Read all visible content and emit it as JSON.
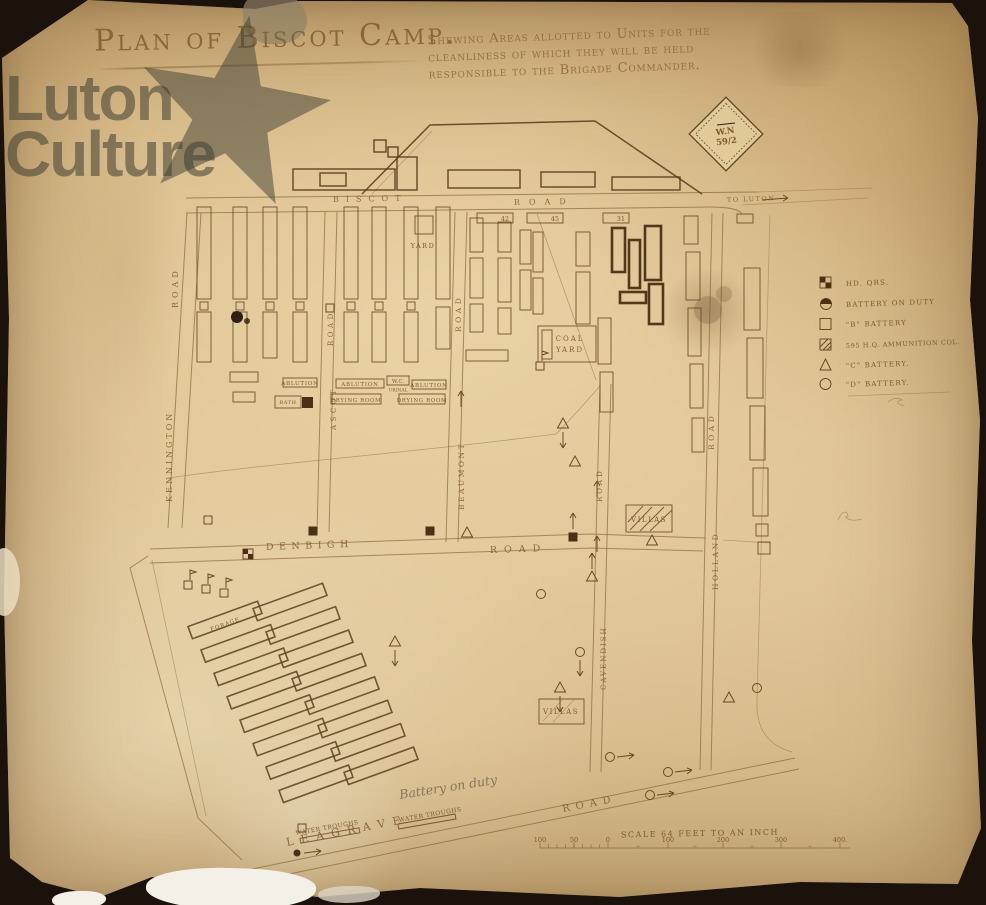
{
  "title": {
    "main": "Plan of Biscot Camp.",
    "sub1": "Shewing Areas allotted to Units for the",
    "sub2": "cleanliness of which they will be held",
    "sub3": "responsible to the Brigade Commander."
  },
  "watermark": {
    "line1": "Luton",
    "line2": "Culture"
  },
  "stamp": {
    "line1": "W.N",
    "line2": "59/2"
  },
  "roads": {
    "biscot": {
      "name": "BISCOT",
      "suffix": "ROAD"
    },
    "to_luton": "TO LUTON",
    "kennington": {
      "name": "KENNINGTON",
      "suffix": "ROAD"
    },
    "ascot": {
      "name": "ASCOT",
      "suffix": "ROAD"
    },
    "beaumont": {
      "name": "BEAUMONT",
      "suffix": "ROAD"
    },
    "cavendish": {
      "name": "CAVENDISH",
      "suffix": "ROAD"
    },
    "holland": {
      "name": "HOLLAND",
      "suffix": "ROAD"
    },
    "denbigh": {
      "name": "DENBIGH",
      "suffix": "ROAD"
    },
    "leagrave": {
      "name": "LEAGRAVE",
      "suffix": "ROAD"
    }
  },
  "labels": {
    "yard": "YARD",
    "coal_yard_line1": "COAL",
    "coal_yard_line2": "YARD",
    "villas_upper": "VILLAS",
    "villas_lower": "VILLAS",
    "ablution_1": "ABLUTION",
    "ablution_2": "ABLUTION",
    "ablution_3": "ABLUTION",
    "drying_room_1": "DRYING ROOM",
    "drying_room_2": "DRYING ROOM",
    "bath": "BATH",
    "wc": "W.C.",
    "urinal": "URINAL",
    "forage": "FORAGE",
    "water_troughs_1": "WATER TROUGHS",
    "water_troughs_2": "WATER TROUGHS",
    "battery_note": "Battery on duty"
  },
  "building_numbers": {
    "n1": "42",
    "n2": "45",
    "n3": "31"
  },
  "legend": {
    "items": [
      {
        "symbol": "checkered-square",
        "label": "HD. QRS."
      },
      {
        "symbol": "half-filled-circle",
        "label": "BATTERY ON DUTY"
      },
      {
        "symbol": "open-square",
        "label": "\"B\" BATTERY"
      },
      {
        "symbol": "hatched-square",
        "label": "595 H.Q. AMMUNITION COL."
      },
      {
        "symbol": "open-triangle",
        "label": "\"C\" BATTERY."
      },
      {
        "symbol": "open-circle",
        "label": "\"D\" BATTERY."
      }
    ]
  },
  "scale": {
    "title": "SCALE 64 FEET TO AN INCH",
    "ticks": [
      "100",
      "50",
      "0",
      "100",
      "200",
      "300",
      "400."
    ]
  },
  "colors": {
    "paper": "#d6b984",
    "ink": "#6b4a26",
    "pencil": "#8a775a",
    "watermark": "#3c3e34"
  }
}
